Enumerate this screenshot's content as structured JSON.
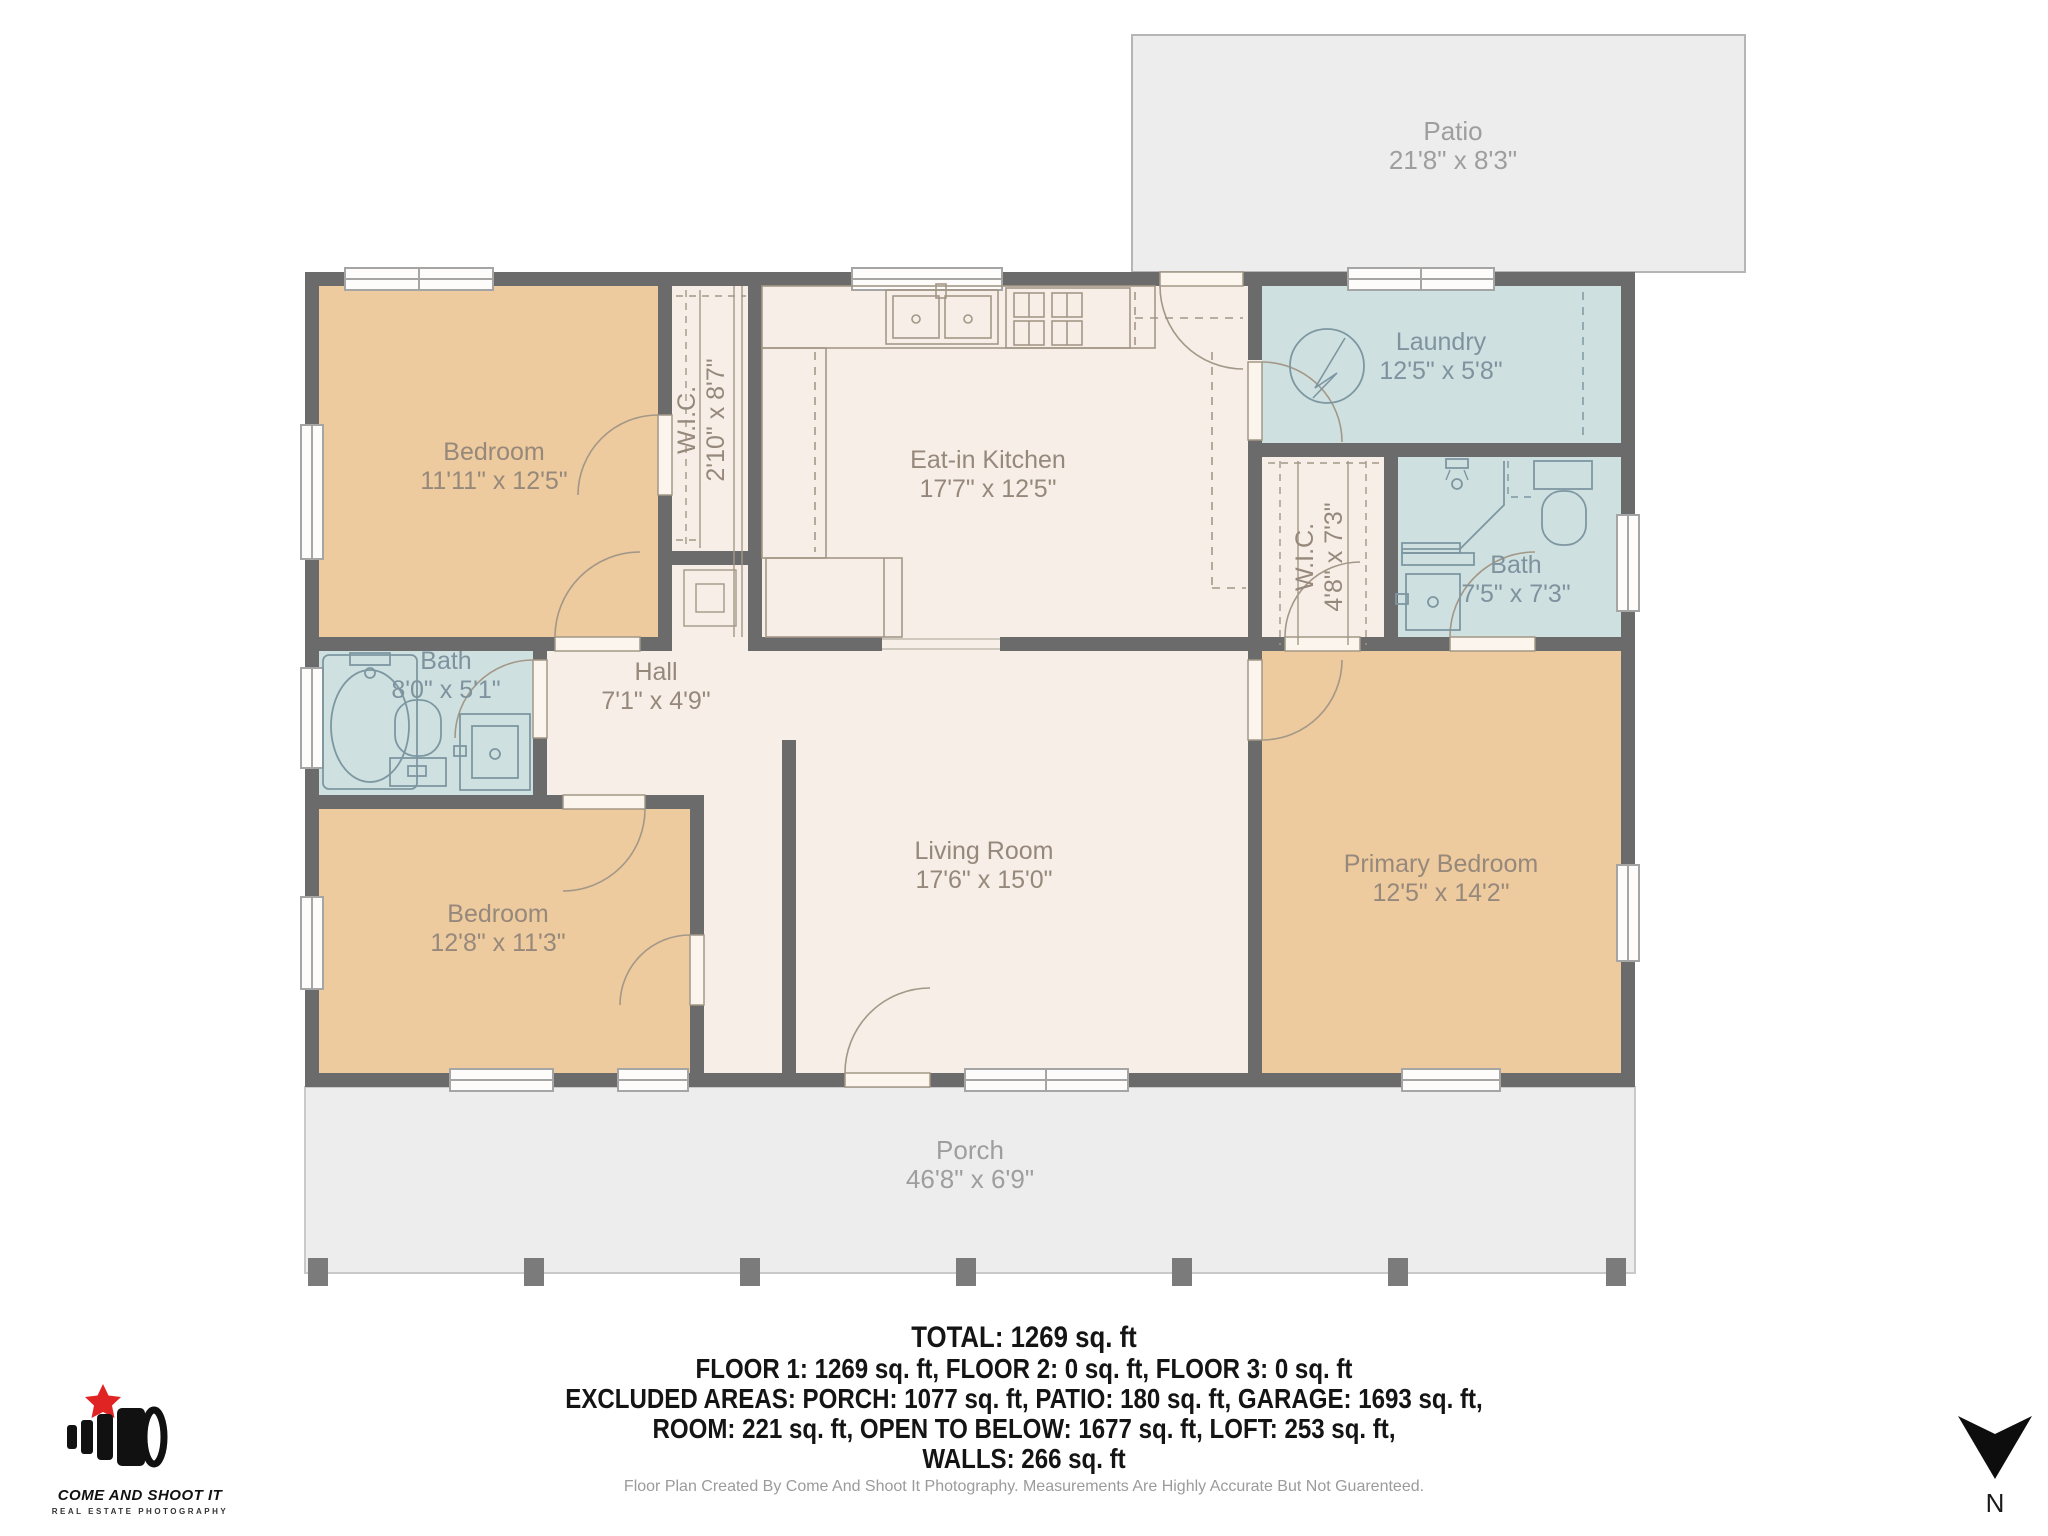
{
  "plan": {
    "colors": {
      "wall": "#6b6b6b",
      "floor_cream": "#f6eee7",
      "floor_tan": "#eeca9f",
      "floor_wet": "#cfe0e1",
      "outdoor": "#ededed",
      "label_warm": "#96897b",
      "label_wet": "#7e939e",
      "label_outdoor": "#9e9e9e"
    },
    "rooms": [
      {
        "id": "patio",
        "name": "Patio",
        "dims": "21'8\" x 8'3\""
      },
      {
        "id": "bedroom-1",
        "name": "Bedroom",
        "dims": "11'11\" x 12'5\""
      },
      {
        "id": "wic-1",
        "name": "W.I.C.",
        "dims": "2'10\" x 8'7\""
      },
      {
        "id": "kitchen",
        "name": "Eat-in Kitchen",
        "dims": "17'7\" x 12'5\""
      },
      {
        "id": "laundry",
        "name": "Laundry",
        "dims": "12'5\" x 5'8\""
      },
      {
        "id": "wic-2",
        "name": "W.I.C.",
        "dims": "4'8\" x 7'3\""
      },
      {
        "id": "bath-2",
        "name": "Bath",
        "dims": "7'5\" x 7'3\""
      },
      {
        "id": "bath-1",
        "name": "Bath",
        "dims": "8'0\" x 5'1\""
      },
      {
        "id": "hall",
        "name": "Hall",
        "dims": "7'1\" x 4'9\""
      },
      {
        "id": "bedroom-2",
        "name": "Bedroom",
        "dims": "12'8\" x 11'3\""
      },
      {
        "id": "living",
        "name": "Living Room",
        "dims": "17'6\" x 15'0\""
      },
      {
        "id": "primary",
        "name": "Primary Bedroom",
        "dims": "12'5\" x 14'2\""
      },
      {
        "id": "porch",
        "name": "Porch",
        "dims": "46'8\" x 6'9\""
      }
    ]
  },
  "summary": {
    "total": "TOTAL: 1269 sq. ft",
    "line1": "FLOOR 1: 1269 sq. ft, FLOOR 2: 0 sq. ft, FLOOR 3: 0 sq. ft",
    "line2": "EXCLUDED AREAS: PORCH: 1077 sq. ft, PATIO: 180 sq. ft, GARAGE: 1693 sq. ft,",
    "line3": "ROOM: 221 sq. ft, OPEN TO BELOW: 1677 sq. ft, LOFT: 253 sq. ft,",
    "line4": "WALLS: 266 sq. ft",
    "disclaimer": "Floor Plan Created By Come And Shoot It Photography. Measurements Are Highly Accurate But Not Guarenteed."
  },
  "logo": {
    "title": "COME AND SHOOT IT",
    "subtitle": "REAL ESTATE PHOTOGRAPHY",
    "star_color": "#e02424"
  },
  "compass": {
    "label": "N"
  }
}
